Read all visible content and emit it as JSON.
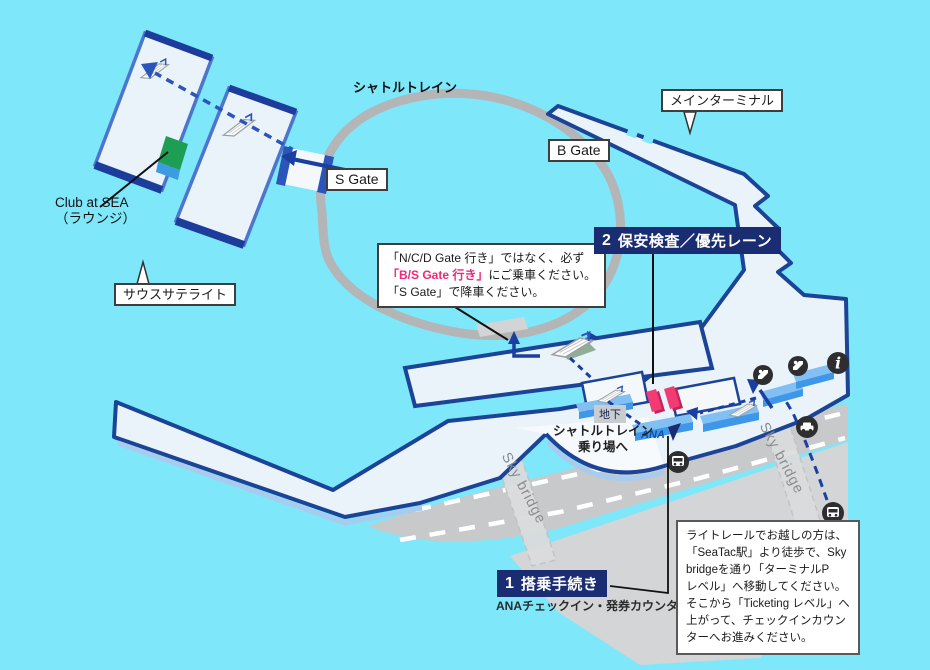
{
  "labels": {
    "shuttle_train": "シャトルトレイン",
    "s_gate": "S Gate",
    "b_gate": "B Gate",
    "main_terminal": "メインターミナル",
    "south_satellite": "サウスサテライト",
    "club_lounge_line1": "Club at SEA",
    "club_lounge_line2": "（ラウンジ）",
    "basement": "地下",
    "shuttle_platform_line1": "シャトルトレイン",
    "shuttle_platform_line2": "乗り場へ",
    "sky_bridge_left": "Sky bridge",
    "sky_bridge_right": "Sky bridge",
    "ana_logo": "ANA"
  },
  "steps": {
    "boarding": {
      "number": "1",
      "title": "搭乗手続き",
      "subtitle": "ANAチェックイン・発券カウンター"
    },
    "security": {
      "number": "2",
      "title": "保安検査／優先レーン"
    }
  },
  "shuttle_note": {
    "line1": "「N/C/D Gate 行き」ではなく、必ず",
    "line2_em": "「B/S Gate 行き」",
    "line2_rest": "にご乗車ください。",
    "line3": "「S Gate」で降車ください。"
  },
  "light_rail_info": {
    "lines": [
      "ライトレールでお越しの方は、",
      "「SeaTac駅」より徒歩で、Sky",
      "bridgeを通り「ターミナルP",
      "レベル」へ移動してください。",
      "そこから「Ticketing レベル」へ",
      "上がって、チェックインカウン",
      "ターへお進みください。"
    ]
  },
  "icons": {
    "info": "information",
    "escalator": "escalator",
    "car": "car access",
    "bus": "bus stop",
    "light_rail": "light rail station"
  },
  "colors": {
    "background": "#7EE7FA",
    "building_fill": "#EAF3FA",
    "terminal_border": "#1B4396",
    "satellite_border": "#4C76CE",
    "shuttle_loop": "#B3B5B7",
    "road": "#C7C9CB",
    "counter_blue": "#3E97E8",
    "priority_pink": "#F23A74",
    "lounge_green": "#1D9E53",
    "badge_navy": "#1A2C72",
    "highlight_pink": "#F1267C",
    "route_navy": "#1B3FA5"
  }
}
